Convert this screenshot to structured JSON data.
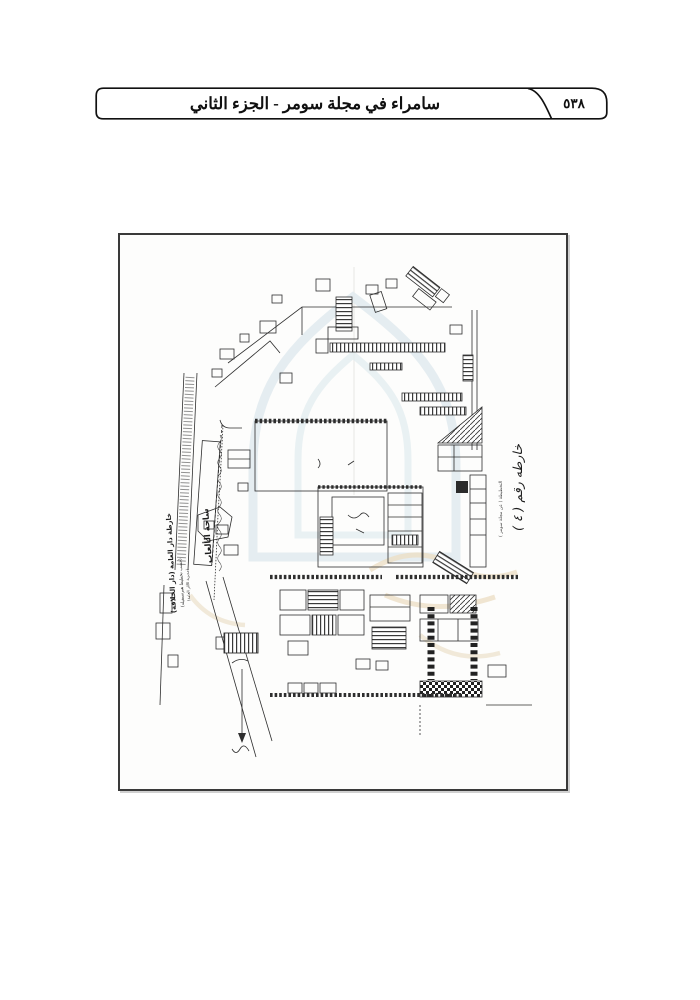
{
  "header": {
    "title": "سامراء في مجلة سومر - الجزء الثاني",
    "page_number": "٥٣٨"
  },
  "figure": {
    "caption_main": "خارطة دار العامة (دار الخلافة)",
    "caption_sub1": "(حسب تخطيط هيرتسفيلد)",
    "caption_sub2": "(مديرية الآثار العامة)",
    "street_label": "ساحة الألعاب",
    "map_number_label": "خارطه رقم ( ٤ )",
    "source_note": "التخطيطة ( عن مجلة سومر )"
  },
  "colors": {
    "ink": "#2e2e2e",
    "frame_border": "#3a3a3a",
    "watermark_blue": "#dfeaee",
    "watermark_cream": "#ecdfc6"
  }
}
